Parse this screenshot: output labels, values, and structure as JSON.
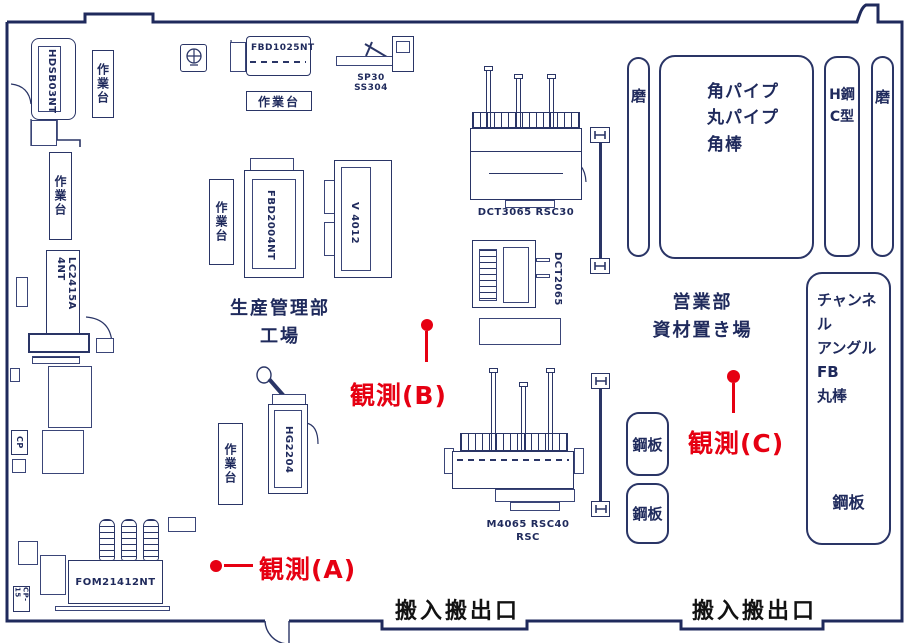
{
  "colors": {
    "line_navy": "#2a3566",
    "text_navy": "#1f2a5c",
    "observation_red": "#e60012",
    "entrance_black": "#121212"
  },
  "labels": {
    "worktable": "作業台",
    "entrance": "搬入搬出口"
  },
  "areas": {
    "production_line1": "生産管理部",
    "production_line2": "工場",
    "sales_line1": "営業部",
    "sales_line2": "資材置き場"
  },
  "machines": {
    "hdsb03nt": "HDSB03NT",
    "fbd1025nt": "FBD1025NT",
    "sp30": "SP30 SS304",
    "fbd2004nt": "FBD2004NT",
    "v4012": "V 4012",
    "dct3065": "DCT3065 RSC30",
    "dct2065": "DCT2065",
    "lc2415a": "LC2415A 4NT",
    "hg2204": "HG2204",
    "fom21412nt": "FOM21412NT",
    "m4065_line1": "M4065 RSC40",
    "m4065_line2": "RSC",
    "cp": "CP",
    "cp15": "CP-15"
  },
  "storage": {
    "polish_left": "磨",
    "pipes_line1": "角パイプ",
    "pipes_line2": "丸パイプ",
    "pipes_line3": "角棒",
    "h_steel_line1": "H鋼",
    "h_steel_line2": "C型",
    "polish_right": "磨",
    "channel_line1": "チャンネル",
    "channel_line2": "アングル",
    "channel_line3": "FB",
    "channel_line4": "丸棒",
    "steel_plate": "鋼板"
  },
  "observations": {
    "a": "観測(A)",
    "b": "観測(B)",
    "c": "観測(C)"
  }
}
